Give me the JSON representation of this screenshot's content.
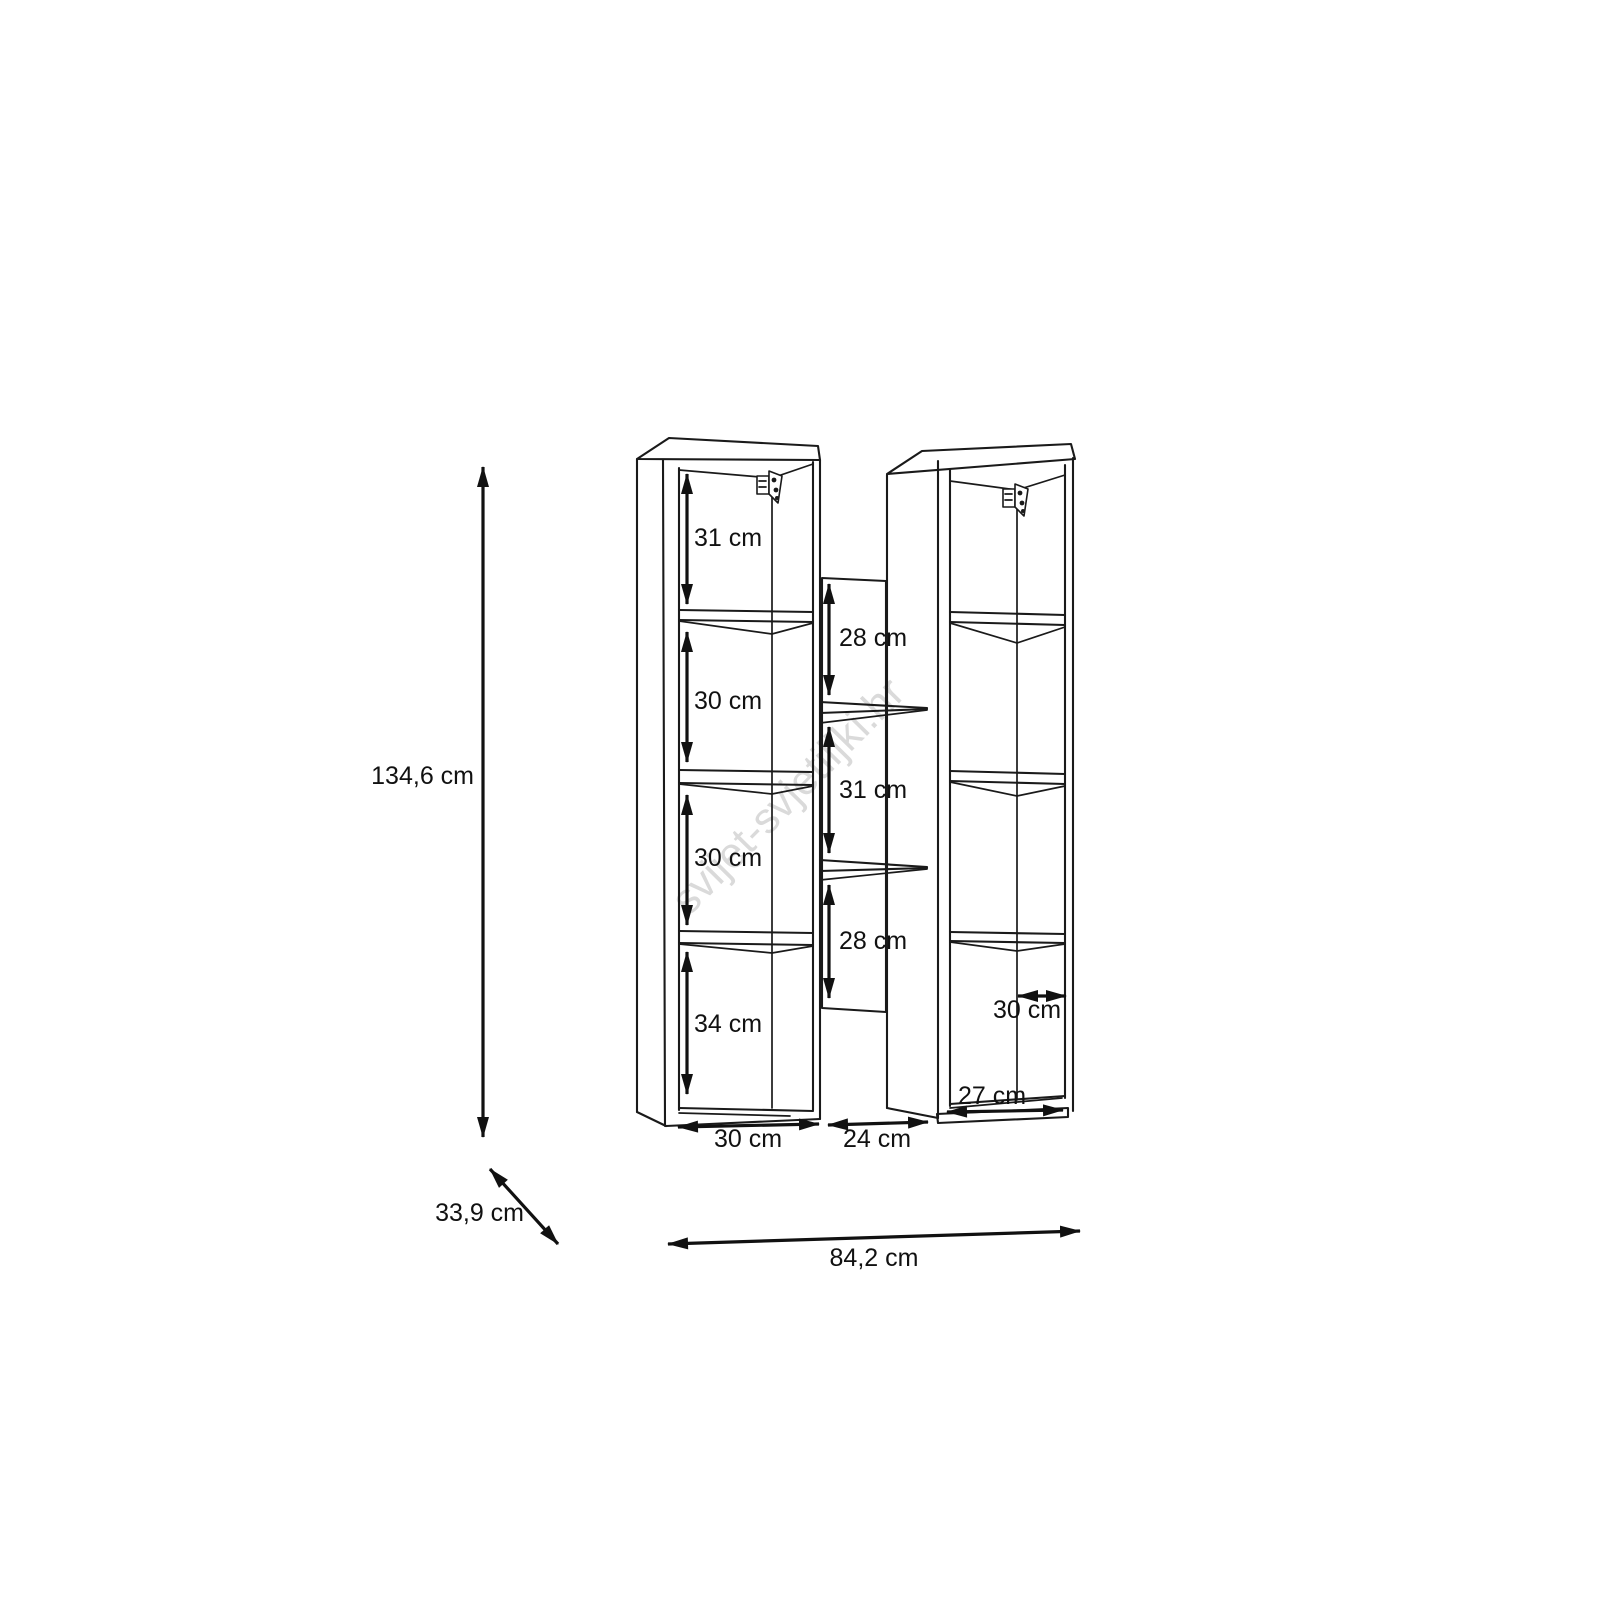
{
  "diagram": {
    "watermark": "svijet-svjetiljki.hr",
    "overall": {
      "height": "134,6 cm",
      "width": "84,2 cm",
      "depth": "33,9 cm"
    },
    "left_cabinet": {
      "compartments": [
        "31 cm",
        "30 cm",
        "30 cm",
        "34 cm"
      ],
      "bottom_width": "30 cm"
    },
    "middle_column": {
      "compartments": [
        "28 cm",
        "31 cm",
        "28 cm"
      ],
      "bottom_width": "24 cm"
    },
    "right_cabinet": {
      "shelf_width": "30 cm",
      "bottom_width": "27 cm"
    }
  },
  "colors": {
    "line": "#1a1a1a",
    "dimension": "#111111",
    "watermark": "#dadada",
    "background": "#ffffff"
  }
}
